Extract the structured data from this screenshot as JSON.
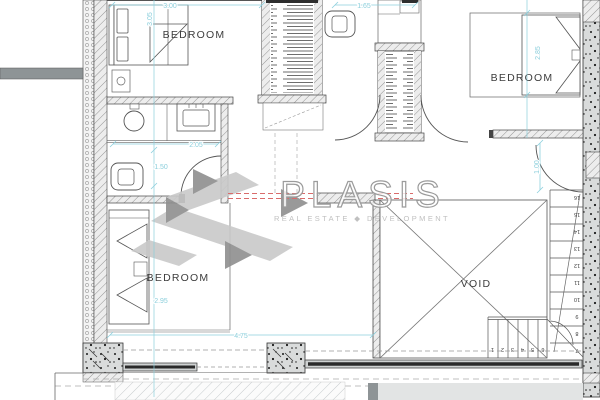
{
  "logo": {
    "wordmark": "PLASIS",
    "tagline": "REAL ESTATE ◆ DEVELOPMENT"
  },
  "rooms": {
    "bedroom_top_left": "BEDROOM",
    "bedroom_top_right": "BEDROOM",
    "bedroom_bottom_left": "BEDROOM",
    "void": "VOID"
  },
  "dimensions": {
    "bed1_width": "3.00",
    "bed1_depth": "3.05",
    "wc_width": "1.65",
    "bed2_depth": "2.85",
    "bath_width": "2.05",
    "bath_depth": "1.50",
    "landing_width": "1.00",
    "bed3_depth": "2.95",
    "south_width": "4.75"
  },
  "stairs": {
    "lower_steps": [
      "1",
      "2",
      "3",
      "4",
      "5",
      "6"
    ],
    "upper_steps": [
      "7",
      "8",
      "9",
      "10",
      "11",
      "12",
      "13",
      "14",
      "15",
      "16"
    ]
  },
  "colors": {
    "dimension_cyan": "#8ccfdc",
    "centerline_red": "#d96b6b",
    "logo_light": "#c9c9c9",
    "logo_dark": "#8f8f8f",
    "logo_outline": "#9b9b9b",
    "logo_tagline": "#c0c0c0"
  }
}
